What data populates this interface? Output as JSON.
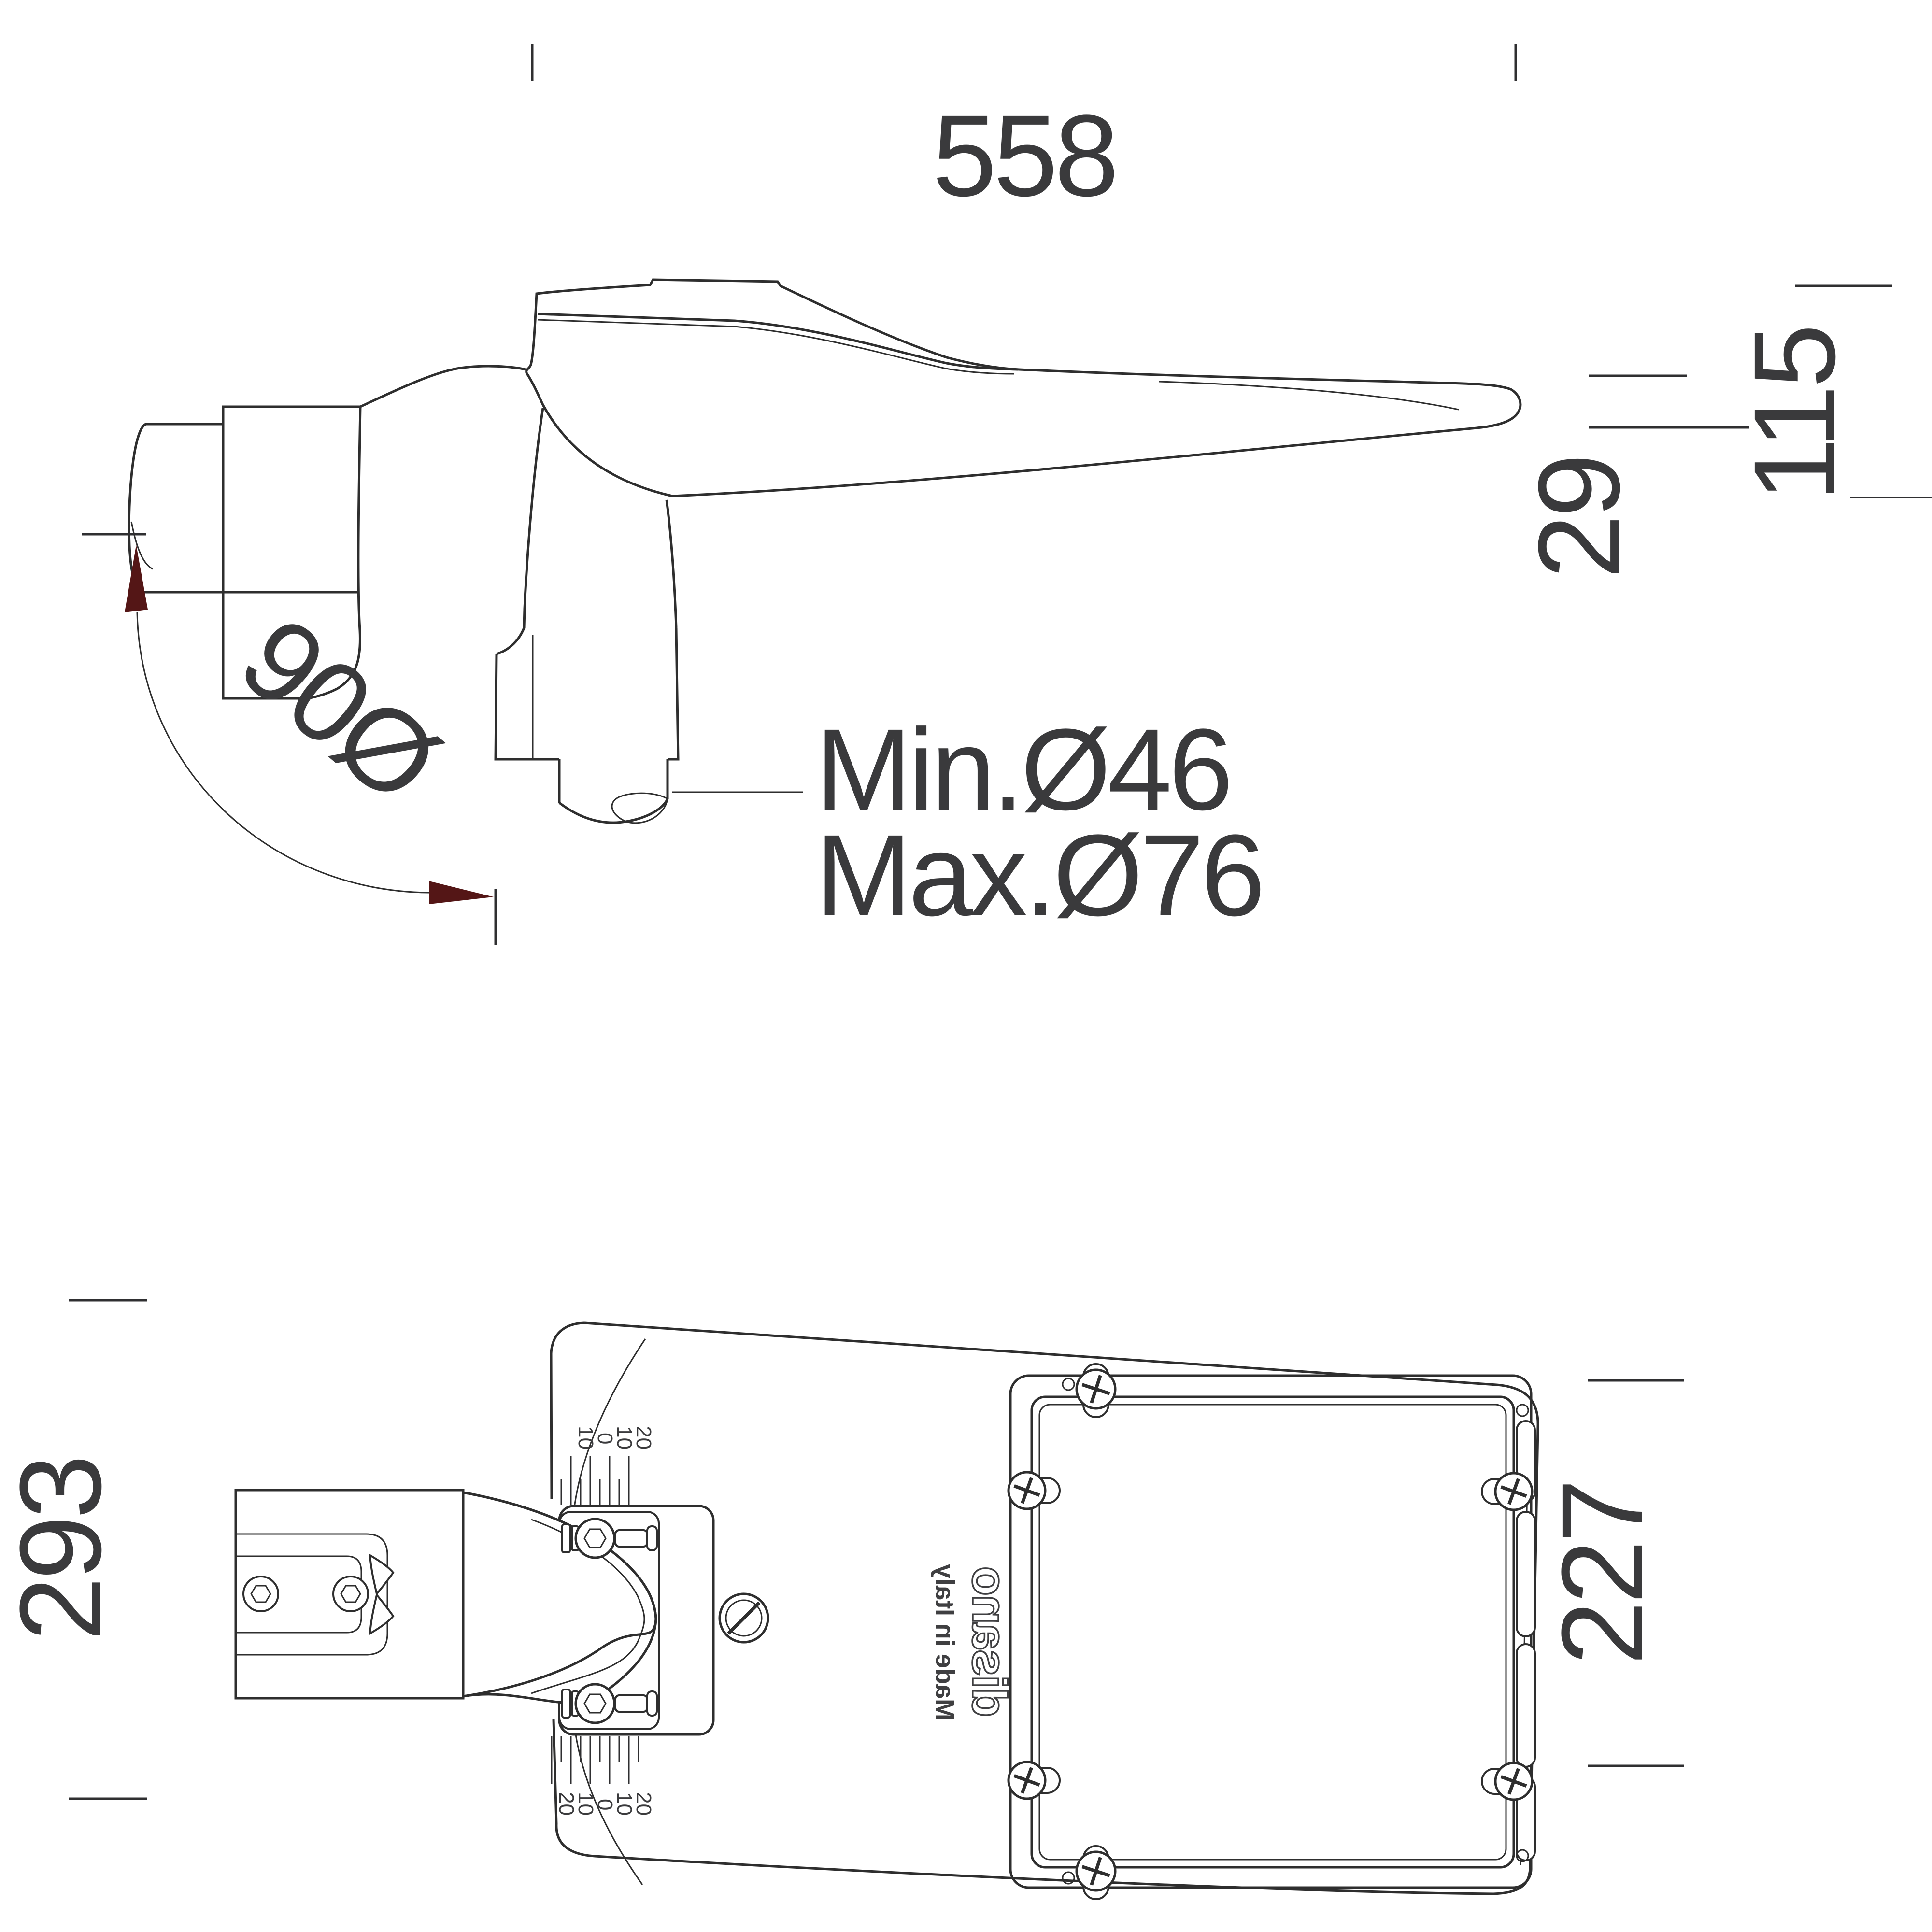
{
  "side_view": {
    "dim_width": "558",
    "dim_height_total": "115",
    "dim_height_arm": "29",
    "rotation_label": "90Ø",
    "pole_min_label": "Min.Ø46",
    "pole_max_label": "Max.Ø76"
  },
  "bottom_view": {
    "dim_length": "293",
    "dim_panel": "227",
    "logo": "disano",
    "made_in": "Made in Italy",
    "scale_top": {
      "labels": [
        "10",
        "0",
        "10",
        "20"
      ]
    },
    "scale_bottom": {
      "labels": [
        "20",
        "10",
        "0",
        "10",
        "20"
      ]
    }
  },
  "colors": {
    "line": "#2e2e2e",
    "text": "#3a3a3c",
    "arrow": "#541616",
    "background": "#ffffff"
  }
}
